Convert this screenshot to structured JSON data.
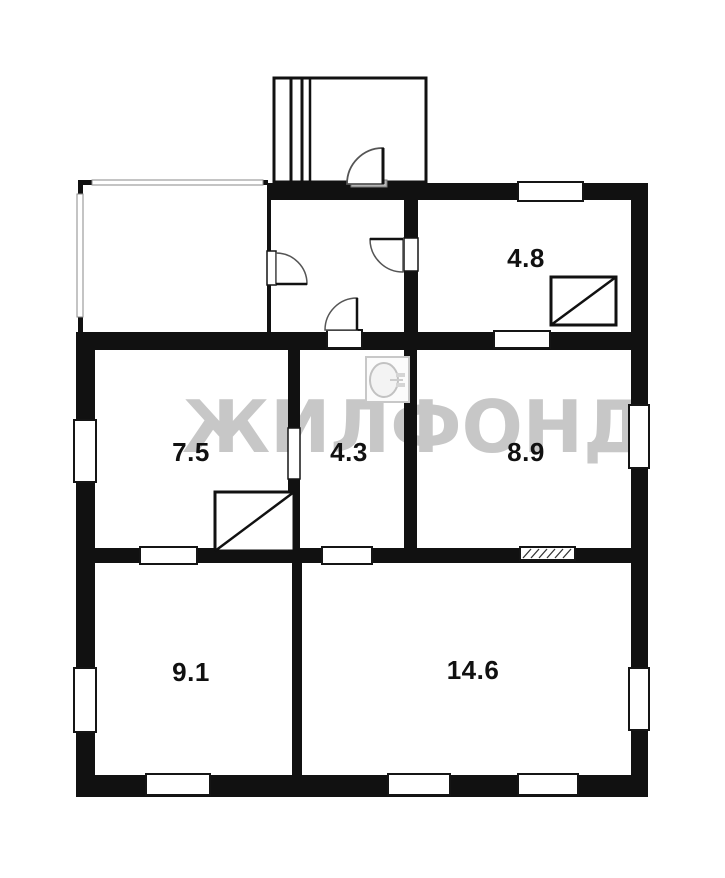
{
  "floorplan": {
    "watermark": "ЖИЛФОНД",
    "rooms": [
      {
        "label": "4.8"
      },
      {
        "label": "7.5"
      },
      {
        "label": "4.3"
      },
      {
        "label": "8.9"
      },
      {
        "label": "9.1"
      },
      {
        "label": "14.6"
      }
    ],
    "colors": {
      "wall": "#111111",
      "background": "#ffffff",
      "watermark": "#c7c7c7",
      "fixture_gray": "#c8c8c8",
      "threshold_gray": "#b5b5b5"
    },
    "icons": {
      "stove": "rect-with-diagonal",
      "sink": "square-with-oval-basin",
      "door": "quarter-circle-swing",
      "window": "white-gap-in-wall",
      "vent": "hatched-opening",
      "porch_steps": "parallel-lines"
    }
  }
}
